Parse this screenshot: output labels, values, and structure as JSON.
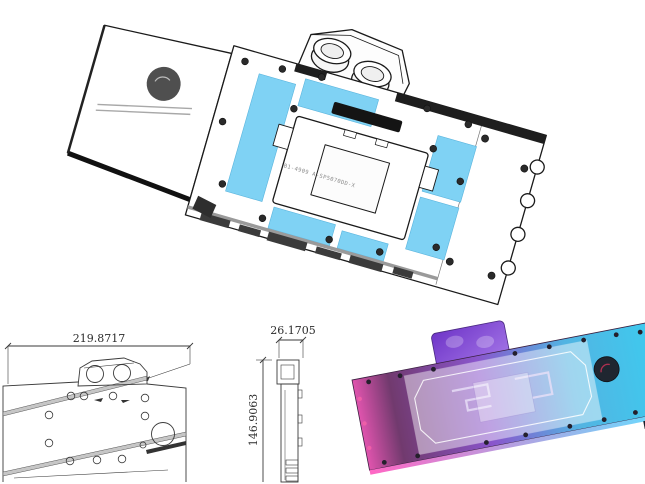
{
  "colors": {
    "background": "#ffffff",
    "line_art": "#1a1a1a",
    "thermal_pad_blue": "#7fd2f4",
    "drawing_gray": "#c6c6c6",
    "badge_gray": "#4f4f4f",
    "rgb_gradient": [
      "#e054ae",
      "#713a6e",
      "#8a55cc",
      "#52b4e2",
      "#3fc9ee"
    ],
    "rgb_terminal": [
      "#6f35c8",
      "#a678e8"
    ],
    "rgb_badge": "#1f2630"
  },
  "main_render": {
    "engraving": "B1-4909 A-SP5070DD-X"
  },
  "dimension_drawing": {
    "width_mm": "219.8717",
    "thickness_mm": "26.1705",
    "height_mm": "146.9063"
  }
}
